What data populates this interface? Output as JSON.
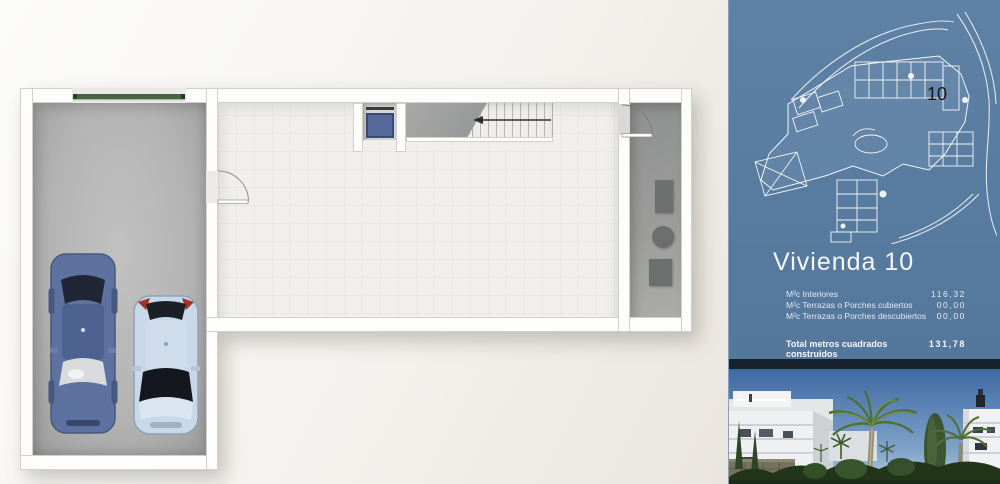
{
  "floor_plan": {
    "rooms": {
      "garage": "garage",
      "main_room": "basement-room",
      "storage_room": "installations-room"
    },
    "fixtures": {
      "garage_door": "green-sectional-door",
      "elevator": "elevator-shaft-with-car",
      "stairs": "staircase-with-direction-arrow"
    },
    "colors": {
      "garage_door": "#47663e",
      "elevator_car": "#56699b",
      "sedan_body": "#5d72a0",
      "hatchback_body": "#c9d8e9",
      "garage_floor": "#b4b4b4",
      "main_floor": "#f1efeb"
    }
  },
  "panel": {
    "background_color": "#567a9e",
    "site_plan": {
      "unit_label": "10",
      "line_color": "#ffffff"
    },
    "title": "Vivienda 10",
    "rows": [
      {
        "label": "M²c Interiores",
        "value": "116,32"
      },
      {
        "label": "M²c Terrazas o Porches cubiertos",
        "value": "00,00"
      },
      {
        "label": "M²c Terrazas o Porches descubiertos",
        "value": "00,00"
      }
    ],
    "total": {
      "label": "Total metros cuadrados construidos",
      "value": "131,78"
    }
  }
}
